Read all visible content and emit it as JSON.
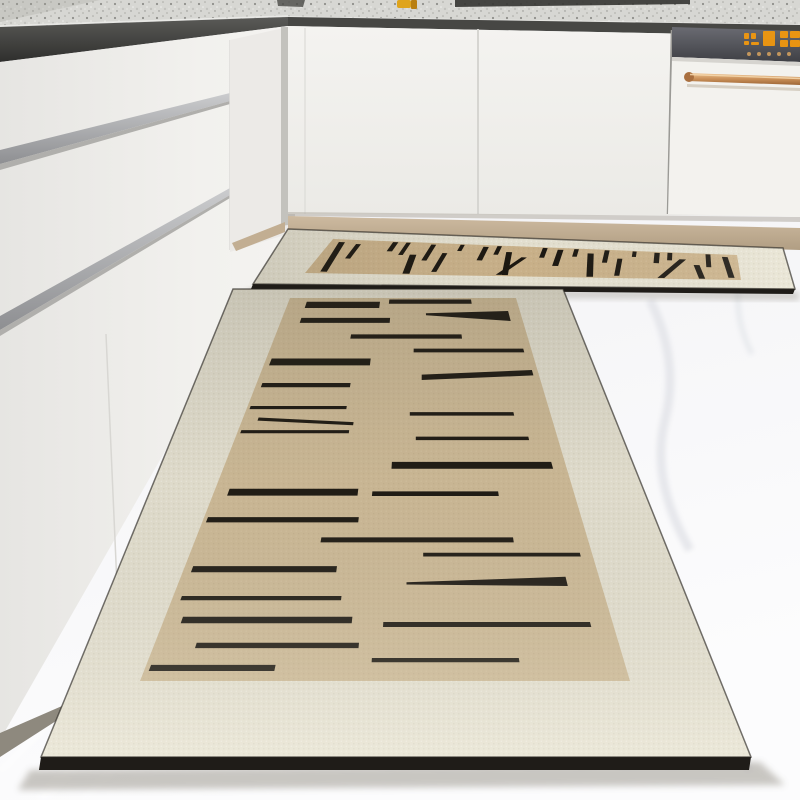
{
  "scene": {
    "alt": "Modern white kitchen corner with handleless cabinets, grey speckled stone countertop, built-in dishwasher with copper handle and amber LED panel, and a two-piece beige kitchen floor mat set with black abstract dash pattern on white marble floor"
  },
  "palette": {
    "floor_base": "#ededf0",
    "floor_mid": "#f6f6f8",
    "floor_light": "#fcfcfd",
    "marble_vein": "#e2e4e9",
    "counter_base": "#d7d7d3",
    "counter_speck_dark": "#8f8f8b",
    "counter_speck_mid": "#aaaaa5",
    "counter_speck_light": "#efefec",
    "sink_slot": "#353532",
    "counter_item_yellow": "#dfa41c",
    "counter_item_orange": "#b97f12",
    "recess_dark": "#2f2f2d",
    "recess_mid": "#5a5a57",
    "cabinet_white": "#f3f2ef",
    "cabinet_white_shade": "#e6e5e2",
    "cabinet_seam": "#d6d5d1",
    "metal_groove_light": "#cbccce",
    "metal_groove_dark": "#8e8f92",
    "corner_shadow": "#a3a19b",
    "plinth_light": "#cdbaa0",
    "plinth_dark": "#b19e83",
    "dw_panel_top": "#6a6b72",
    "dw_panel_bottom": "#3f4045",
    "dw_door": "#f3f2ee",
    "led_amber": "#f0980f",
    "led_button": "#cf9f5e",
    "copper_light": "#eec492",
    "copper_mid": "#c98f58",
    "copper_dark": "#9d6535",
    "mat_border": "#e7e3d3",
    "mat_field_large": "#cfbb97",
    "mat_field_small": "#cbb28a",
    "mat_black": "#17130d",
    "mat_piping": "#2b2823",
    "mat_edge": "#1f1c18",
    "shadow": "#8a857a"
  },
  "mats": {
    "small": {
      "name": "small-mat",
      "outer": [
        [
          288,
          229
        ],
        [
          783,
          248
        ],
        [
          795,
          289
        ],
        [
          253,
          284
        ]
      ],
      "field": [
        [
          333,
          239
        ],
        [
          737,
          255
        ],
        [
          741,
          280
        ],
        [
          305,
          273
        ]
      ],
      "field_color": "#cbb28a",
      "edge_px": 5,
      "dashes": [
        {
          "u": 0.02,
          "w": 0.015,
          "v1": 0.08,
          "v2": 0.95,
          "du": 0.012
        },
        {
          "u": 0.065,
          "w": 0.012,
          "v1": 0.12,
          "v2": 0.55
        },
        {
          "u": 0.15,
          "w": 0.013,
          "v1": 0.02,
          "v2": 0.3
        },
        {
          "u": 0.183,
          "w": 0.011,
          "v1": 0.02,
          "v2": 0.4
        },
        {
          "u": 0.21,
          "w": 0.016,
          "v1": 0.38,
          "v2": 0.97,
          "du": 0.012
        },
        {
          "u": 0.246,
          "w": 0.012,
          "v1": 0.05,
          "v2": 0.55
        },
        {
          "u": 0.285,
          "w": 0.012,
          "v1": 0.3,
          "v2": 0.9
        },
        {
          "u": 0.317,
          "w": 0.01,
          "v1": 0.02,
          "v2": 0.22
        },
        {
          "u": 0.375,
          "w": 0.013,
          "v1": 0.06,
          "v2": 0.5
        },
        {
          "u": 0.408,
          "w": 0.011,
          "v1": 0.02,
          "v2": 0.3
        },
        {
          "u": 0.436,
          "w": 0.014,
          "v1": 0.2,
          "v2": 0.96,
          "du": 0.014
        },
        {
          "u": 0.478,
          "w": 0.013,
          "v1": 0.36,
          "v2": 0.96,
          "du": -0.042
        },
        {
          "u": 0.52,
          "w": 0.012,
          "v1": 0.02,
          "v2": 0.35
        },
        {
          "u": 0.558,
          "w": 0.014,
          "v1": 0.06,
          "v2": 0.62
        },
        {
          "u": 0.598,
          "w": 0.011,
          "v1": 0.02,
          "v2": 0.28
        },
        {
          "u": 0.633,
          "w": 0.015,
          "v1": 0.15,
          "v2": 0.97,
          "du": 0.012
        },
        {
          "u": 0.673,
          "w": 0.012,
          "v1": 0.02,
          "v2": 0.46
        },
        {
          "u": 0.708,
          "w": 0.012,
          "v1": 0.3,
          "v2": 0.92
        },
        {
          "u": 0.742,
          "w": 0.01,
          "v1": 0.02,
          "v2": 0.22
        },
        {
          "u": 0.796,
          "w": 0.013,
          "v1": 0.04,
          "v2": 0.42
        },
        {
          "u": 0.828,
          "w": 0.012,
          "v1": 0.02,
          "v2": 0.3
        },
        {
          "u": 0.858,
          "w": 0.016,
          "v1": 0.25,
          "v2": 0.97,
          "du": -0.05
        },
        {
          "u": 0.892,
          "w": 0.014,
          "v1": 0.45,
          "v2": 0.97,
          "du": 0.012
        },
        {
          "u": 0.922,
          "w": 0.012,
          "v1": 0.02,
          "v2": 0.52
        },
        {
          "u": 0.962,
          "w": 0.014,
          "v1": 0.1,
          "v2": 0.92,
          "du": 0.01
        }
      ]
    },
    "large": {
      "name": "large-mat",
      "outer": [
        [
          233,
          289
        ],
        [
          563,
          289
        ],
        [
          751,
          757
        ],
        [
          41,
          757
        ]
      ],
      "field": [
        [
          290,
          298
        ],
        [
          516,
          298
        ],
        [
          630,
          681
        ],
        [
          140,
          681
        ]
      ],
      "field_color": "#cfbb97",
      "edge_px": 13,
      "bars": [
        {
          "u1": 0.08,
          "u2": 0.4,
          "v": 0.01,
          "t": 0.016
        },
        {
          "u1": 0.44,
          "u2": 0.8,
          "v": 0.004,
          "t": 0.011
        },
        {
          "u1": 0.08,
          "u2": 0.45,
          "v": 0.052,
          "t": 0.013
        },
        {
          "u1": 0.6,
          "u2": 0.95,
          "v": 0.04,
          "t": 0.005,
          "t2": 0.026,
          "dv": -0.006
        },
        {
          "u1": 0.3,
          "u2": 0.74,
          "v": 0.095,
          "t": 0.011
        },
        {
          "u1": 0.55,
          "u2": 0.97,
          "v": 0.132,
          "t": 0.01
        },
        {
          "u1": 0.02,
          "u2": 0.39,
          "v": 0.158,
          "t": 0.018
        },
        {
          "u1": 0.58,
          "u2": 0.98,
          "v": 0.2,
          "t": 0.014,
          "dv": -0.012
        },
        {
          "u1": 0.02,
          "u2": 0.33,
          "v": 0.222,
          "t": 0.011
        },
        {
          "u1": 0.01,
          "u2": 0.33,
          "v": 0.282,
          "t": 0.008
        },
        {
          "u1": 0.54,
          "u2": 0.88,
          "v": 0.298,
          "t": 0.009
        },
        {
          "u1": 0.05,
          "u2": 0.36,
          "v": 0.312,
          "t": 0.008,
          "dv": 0.012
        },
        {
          "u1": 0.01,
          "u2": 0.35,
          "v": 0.345,
          "t": 0.008
        },
        {
          "u1": 0.56,
          "u2": 0.91,
          "v": 0.362,
          "t": 0.009
        },
        {
          "u1": 0.49,
          "u2": 0.96,
          "v": 0.428,
          "t": 0.018
        },
        {
          "u1": 0.04,
          "u2": 0.4,
          "v": 0.498,
          "t": 0.018
        },
        {
          "u1": 0.44,
          "u2": 0.79,
          "v": 0.505,
          "t": 0.012
        },
        {
          "u1": 0.01,
          "u2": 0.41,
          "v": 0.572,
          "t": 0.014
        },
        {
          "u1": 0.32,
          "u2": 0.81,
          "v": 0.625,
          "t": 0.013
        },
        {
          "u1": 0.58,
          "u2": 0.97,
          "v": 0.665,
          "t": 0.01
        },
        {
          "u1": 0.02,
          "u2": 0.37,
          "v": 0.7,
          "t": 0.016
        },
        {
          "u1": 0.54,
          "u2": 0.92,
          "v": 0.742,
          "t": 0.006,
          "t2": 0.024,
          "dv": -0.014
        },
        {
          "u1": 0.02,
          "u2": 0.39,
          "v": 0.778,
          "t": 0.011
        },
        {
          "u1": 0.04,
          "u2": 0.42,
          "v": 0.832,
          "t": 0.017
        },
        {
          "u1": 0.49,
          "u2": 0.95,
          "v": 0.846,
          "t": 0.013
        },
        {
          "u1": 0.09,
          "u2": 0.44,
          "v": 0.9,
          "t": 0.014
        },
        {
          "u1": 0.01,
          "u2": 0.27,
          "v": 0.958,
          "t": 0.016
        },
        {
          "u1": 0.47,
          "u2": 0.78,
          "v": 0.94,
          "t": 0.011
        }
      ]
    }
  },
  "dishwasher": {
    "display": {
      "color": "#f0980f",
      "button_color": "#cf9f5e",
      "segments": [
        [
          744,
          33,
          5,
          6
        ],
        [
          751,
          33,
          5,
          6
        ],
        [
          744,
          41,
          5,
          4
        ],
        [
          751,
          42,
          8,
          3
        ],
        [
          763,
          31,
          12,
          15
        ],
        [
          780,
          31,
          8,
          7
        ],
        [
          790,
          31,
          10,
          7
        ],
        [
          780,
          40,
          8,
          7
        ],
        [
          790,
          40,
          10,
          7
        ]
      ],
      "buttons": [
        [
          749,
          54
        ],
        [
          759,
          54
        ],
        [
          769,
          54
        ],
        [
          779,
          54
        ],
        [
          789,
          54
        ]
      ]
    }
  }
}
